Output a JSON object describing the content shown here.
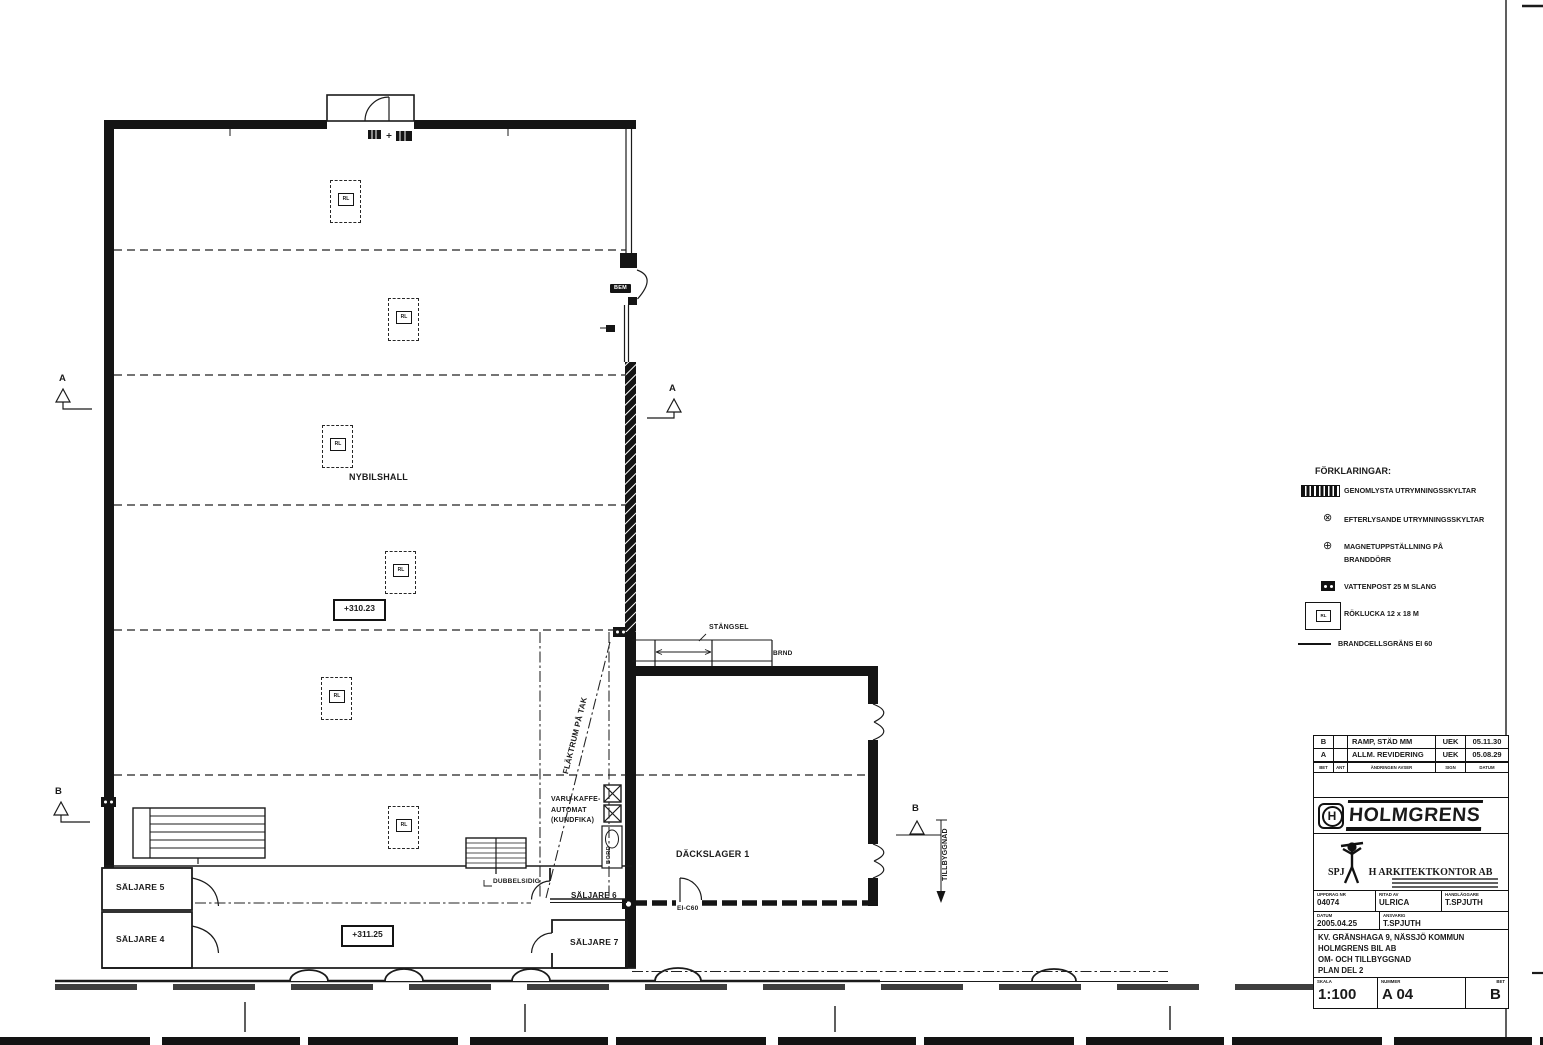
{
  "plan": {
    "rooms": {
      "nybilshall": "NYBILSHALL",
      "dackslager": "DÄCKSLAGER 1",
      "saljare4": "SÄLJARE 4",
      "saljare5": "SÄLJARE 5",
      "saljare6": "SÄLJARE 6",
      "saljare7": "SÄLJARE 7"
    },
    "levels": {
      "hall": "+310.23",
      "lower": "+311.25"
    },
    "annotations": {
      "flaktrum": "FLÄKTRUM PÅ TAK",
      "varukaffe_line1": "VARU-KAFFE-",
      "varukaffe_line2": "AUTOMAT",
      "varukaffe_line3": "(KUNDFIKA)",
      "stangsel": "STÄNGSEL",
      "brand": "BRND",
      "fire_door": "EI-C60",
      "dubbelsidig": "DUBBELSIDIG",
      "tillbyggnad": "TILLBYGGNAD",
      "bord": "BORD",
      "exit_sign": "BEM"
    },
    "rl_label": "RL",
    "sections": {
      "a": "A",
      "b": "B"
    }
  },
  "legend": {
    "title": "FÖRKLARINGAR:",
    "items": [
      {
        "icon": "illuminated-exit-sign-icon",
        "text": "GENOMLYSTA UTRYMNINGSSKYLTAR"
      },
      {
        "icon": "afterglow-exit-sign-icon",
        "text": "EFTERLYSANDE UTRYMNINGSSKYLTAR",
        "glyph": "⊗"
      },
      {
        "icon": "magnet-hold-icon",
        "text": "MAGNETUPPSTÄLLNING PÅ",
        "text2": "BRANDDÖRR",
        "glyph": "⊕"
      },
      {
        "icon": "water-post-icon",
        "text": "VATTENPOST 25 M SLANG"
      },
      {
        "icon": "smoke-hatch-icon",
        "text": "RÖKLUCKA 12 x 18 M"
      },
      {
        "icon": "fire-cell-boundary-line",
        "text": "BRANDCELLSGRÄNS EI 60"
      }
    ]
  },
  "titleblock": {
    "revisions": [
      {
        "bet": "B",
        "desc": "RAMP, STÄD MM",
        "sign": "UEK",
        "date": "05.11.30"
      },
      {
        "bet": "A",
        "desc": "ALLM. REVIDERING",
        "sign": "UEK",
        "date": "05.08.29"
      }
    ],
    "rev_headers": [
      "BET",
      "ANT",
      "ÄNDRINGEN AVSER",
      "SIGN",
      "DATUM"
    ],
    "company": "HOLMGRENS",
    "company_initial": "H",
    "architect_prefix": "SPJ",
    "architect_suffix": "H ARKITEKTKONTOR AB",
    "fields": {
      "uppdrag_label": "UPPDRAG NR",
      "uppdrag": "04074",
      "ritad_label": "RITAD AV",
      "ritad": "ULRICA",
      "handlaggare_label": "HANDLÄGGARE",
      "handlaggare": "T.SPJUTH",
      "datum_label": "DATUM",
      "datum": "2005.04.25",
      "ansvarig_label": "ANSVARIG",
      "ansvarig": "T.SPJUTH"
    },
    "project_lines": [
      "KV. GRÄNSHAGA 9, NÄSSJÖ KOMMUN",
      "HOLMGRENS BIL AB",
      "OM- OCH TILLBYGGNAD",
      "PLAN DEL 2"
    ],
    "scale_label": "SKALA",
    "scale": "1:100",
    "number_label": "NUMMER",
    "number": "A 04",
    "bet_label": "BET",
    "bet": "B"
  }
}
